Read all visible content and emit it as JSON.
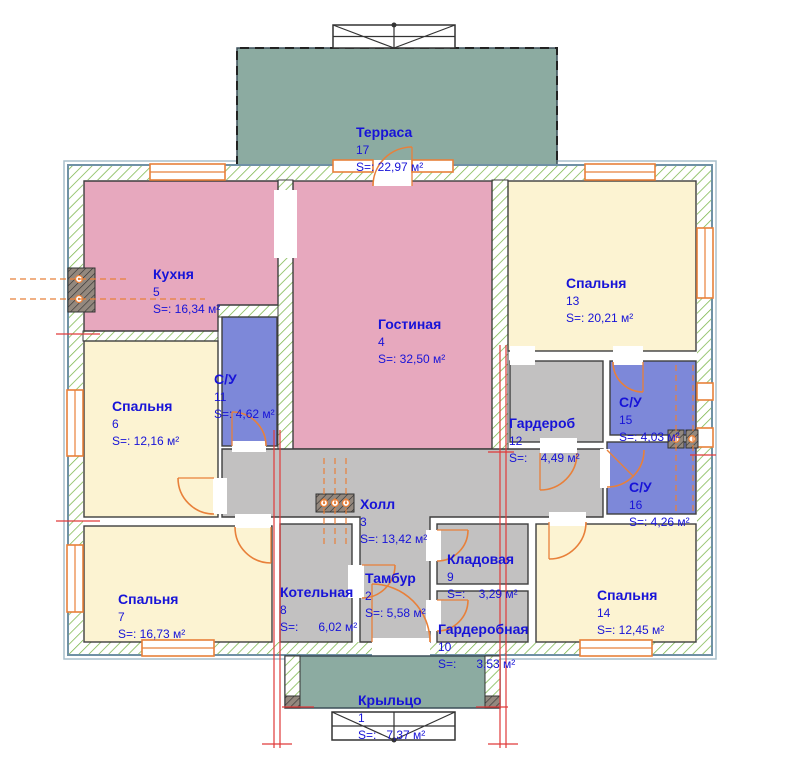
{
  "rooms": {
    "terrace": {
      "name": "Терраса",
      "number": "17",
      "area": "S=: 22,97 м²"
    },
    "kitchen": {
      "name": "Кухня",
      "number": "5",
      "area": "S=: 16,34 м²"
    },
    "living": {
      "name": "Гостиная",
      "number": "4",
      "area": "S=: 32,50 м²"
    },
    "bedroom13": {
      "name": "Спальня",
      "number": "13",
      "area": "S=: 20,21 м²"
    },
    "bedroom6": {
      "name": "Спальня",
      "number": "6",
      "area": "S=: 12,16 м²"
    },
    "bathroom11": {
      "name": "С/У",
      "number": "11",
      "area": "S=: 4,62 м²"
    },
    "bedroom7": {
      "name": "Спальня",
      "number": "7",
      "area": "S=: 16,73 м²"
    },
    "hall": {
      "name": "Холл",
      "number": "3",
      "area": "S=: 13,42 м²"
    },
    "boiler": {
      "name": "Котельная",
      "number": "8",
      "area": "S=:      6,02 м²"
    },
    "tambour": {
      "name": "Тамбур",
      "number": "2",
      "area": "S=: 5,58 м²"
    },
    "storage": {
      "name": "Кладовая",
      "number": "9",
      "area": "S=:    3,29 м²"
    },
    "dressing": {
      "name": "Гардеробная",
      "number": "10",
      "area": "S=:      3,53 м²"
    },
    "wardrobe": {
      "name": "Гардероб",
      "number": "12",
      "area": "S=:    4,49 м²"
    },
    "bathroom15": {
      "name": "С/У",
      "number": "15",
      "area": "S=: 4,03 м²"
    },
    "bathroom16": {
      "name": "С/У",
      "number": "16",
      "area": "S=: 4,26 м²"
    },
    "bedroom14": {
      "name": "Спальня",
      "number": "14",
      "area": "S=: 12,45 м²"
    },
    "porch": {
      "name": "Крыльцо",
      "number": "1",
      "area": "S=:   7,37 м²"
    }
  },
  "colors": {
    "room_pink": "#e7a8be",
    "room_yellow": "#fcf3d2",
    "room_blue": "#7d88d9",
    "room_gray": "#c2c1c1",
    "room_green": "#8caba1",
    "label_blue": "#1713d8",
    "accent_orange": "#e8803a",
    "axis_red": "#e03a3a",
    "wall_line": "#3e3e3e"
  }
}
